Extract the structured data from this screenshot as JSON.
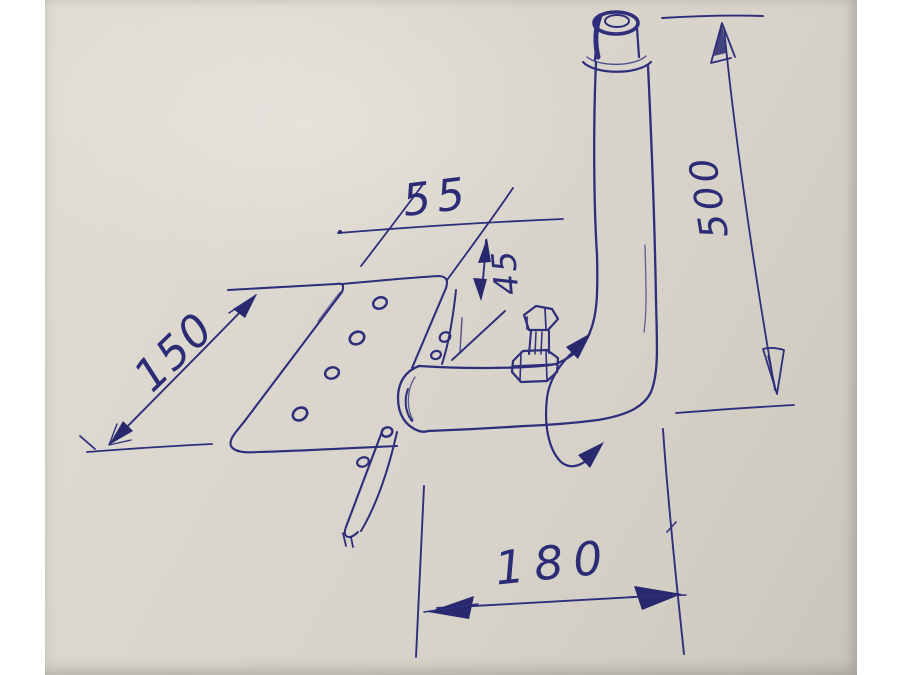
{
  "sketch": {
    "title": "Hand-drawn pipe assembly sketch",
    "description": "Ballpoint-pen engineering sketch of an elbow pipe with a perforated mounting plate, a bolt valve on the horizontal run, and a rotation arrow",
    "dimensions": {
      "plate_length": "150",
      "top_width": "55",
      "drop_height": "45",
      "pipe_height": "500",
      "base_width": "180"
    },
    "parts": [
      "mounting plate with eight holes",
      "horizontal pipe with rounded end cap",
      "pipe elbow",
      "vertical pipe",
      "open pipe collar at top",
      "hex bolt valve",
      "curved rotation arrow"
    ],
    "colors": {
      "ink": "#2e2e7b",
      "paper": "#d9d5cc",
      "margin": "#ffffff"
    }
  }
}
